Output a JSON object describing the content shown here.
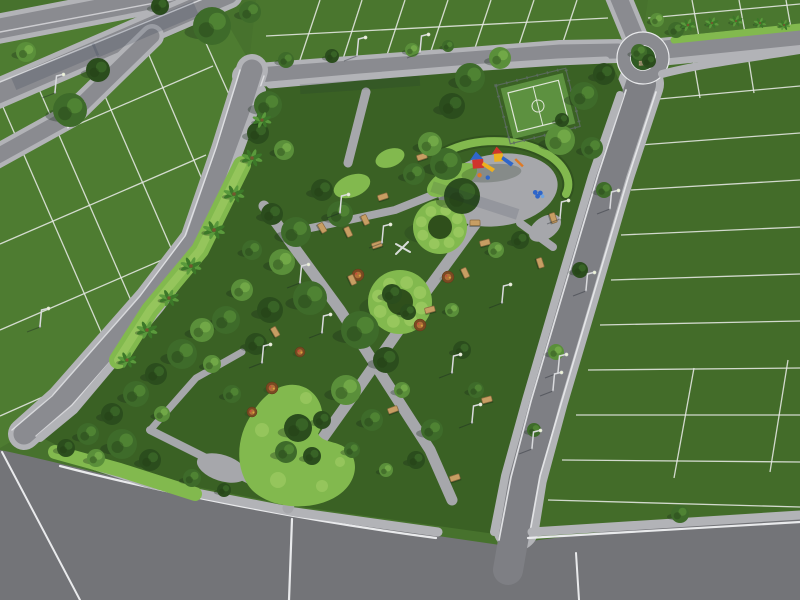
{
  "scene": {
    "title": "aerial-3d-render-residential-park-masterplan",
    "description": "Daylight aerial isometric 3D rendering of a residential land subdivision. A diagonal linear park with walking paths, a fenced mini sports court, a colorful playground plaza, circular clipped hedge rings, a kidney-shaped hedge bed, benches, street lamps and palm trees is surrounded by asphalt roads, a roundabout at top right, and green parcels divided by white lot lines.",
    "view": "aerial isometric",
    "time_of_day": "day"
  },
  "palette": {
    "base": "#47722d",
    "tl": "#4e7c31",
    "tc": "#4a762e",
    "tr": "#4a772f",
    "rb": "#436c29",
    "park_lawn": "#3a6124",
    "road": "#8a8b90",
    "road_main": "#7e7f84",
    "road_dark": "#737478",
    "sidewalk": "#b2b3b7",
    "path": "#a6a7ab",
    "white_line": "#e9eaec",
    "hedge": "#82b94e",
    "hedge_light": "#a5d068",
    "island": "#2f5a22",
    "court": "#5d9140",
    "court_line": "#dfe6d8",
    "fence": "#5c6b60",
    "play_red": "#d0342c",
    "play_blue": "#2f66c9",
    "play_yellow": "#edb01f",
    "play_orange": "#df7a25",
    "bench": "#c79e63",
    "bench_dark": "#8a6a3e",
    "bed_brown": "#7a4a22",
    "bed_orange": "#b06f38",
    "lamp": "#d9dadd",
    "shadow": "rgba(24,44,24,0.32)"
  },
  "features": {
    "lot_lines": [
      [
        0,
        158,
        213,
        66
      ],
      [
        0,
        244,
        206,
        155
      ],
      [
        0,
        330,
        185,
        250
      ],
      [
        0,
        416,
        90,
        376
      ],
      [
        35,
        80,
        136,
        312
      ],
      [
        88,
        57,
        178,
        264
      ],
      [
        140,
        34,
        210,
        198
      ],
      [
        192,
        12,
        236,
        110
      ],
      [
        0,
        100,
        108,
        348
      ],
      [
        298,
        66,
        320,
        0
      ],
      [
        342,
        62,
        362,
        0
      ],
      [
        386,
        58,
        405,
        0
      ],
      [
        430,
        54,
        448,
        0
      ],
      [
        474,
        51,
        491,
        0
      ],
      [
        518,
        48,
        534,
        0
      ],
      [
        562,
        45,
        577,
        0
      ],
      [
        266,
        36,
        608,
        18
      ],
      [
        700,
        42,
        692,
        0
      ],
      [
        746,
        38,
        739,
        0
      ],
      [
        792,
        34,
        786,
        0
      ],
      [
        648,
        18,
        800,
        4
      ],
      [
        648,
        100,
        800,
        86
      ],
      [
        640,
        145,
        800,
        133
      ],
      [
        631,
        190,
        800,
        180
      ],
      [
        621,
        235,
        800,
        227
      ],
      [
        611,
        280,
        800,
        274
      ],
      [
        600,
        325,
        800,
        321
      ],
      [
        588,
        370,
        800,
        368
      ],
      [
        576,
        415,
        800,
        415
      ],
      [
        562,
        460,
        800,
        462
      ],
      [
        548,
        500,
        800,
        507
      ],
      [
        694,
        368,
        674,
        478
      ],
      [
        788,
        360,
        770,
        472
      ],
      [
        700,
        98,
        692,
        52
      ],
      [
        754,
        93,
        747,
        49
      ]
    ],
    "trees": [
      [
        268,
        105,
        14,
        1
      ],
      [
        258,
        133,
        11,
        0
      ],
      [
        284,
        150,
        10,
        2
      ],
      [
        296,
        232,
        15,
        1
      ],
      [
        272,
        214,
        11,
        0
      ],
      [
        282,
        262,
        13,
        2
      ],
      [
        252,
        250,
        10,
        1
      ],
      [
        310,
        298,
        17,
        1
      ],
      [
        270,
        310,
        13,
        0
      ],
      [
        242,
        290,
        11,
        2
      ],
      [
        226,
        320,
        14,
        1
      ],
      [
        256,
        344,
        11,
        0
      ],
      [
        202,
        330,
        12,
        2
      ],
      [
        182,
        354,
        15,
        1
      ],
      [
        156,
        374,
        11,
        0
      ],
      [
        212,
        364,
        9,
        2
      ],
      [
        136,
        394,
        13,
        1
      ],
      [
        112,
        414,
        11,
        0
      ],
      [
        88,
        434,
        11,
        1
      ],
      [
        66,
        448,
        9,
        0
      ],
      [
        162,
        414,
        8,
        2
      ],
      [
        232,
        394,
        9,
        1
      ],
      [
        122,
        444,
        15,
        1
      ],
      [
        150,
        460,
        11,
        0
      ],
      [
        96,
        458,
        9,
        2
      ],
      [
        192,
        478,
        9,
        1
      ],
      [
        224,
        490,
        7,
        0
      ],
      [
        340,
        214,
        13,
        1
      ],
      [
        322,
        190,
        11,
        0
      ],
      [
        360,
        330,
        19,
        1
      ],
      [
        386,
        360,
        13,
        0
      ],
      [
        346,
        390,
        15,
        2
      ],
      [
        372,
        420,
        11,
        1
      ],
      [
        322,
        420,
        9,
        0
      ],
      [
        402,
        390,
        8,
        2
      ],
      [
        432,
        430,
        11,
        1
      ],
      [
        416,
        460,
        9,
        0
      ],
      [
        386,
        470,
        7,
        2
      ],
      [
        352,
        450,
        8,
        1
      ],
      [
        462,
        350,
        9,
        0
      ],
      [
        476,
        390,
        8,
        1
      ],
      [
        452,
        310,
        7,
        2
      ],
      [
        446,
        164,
        16,
        1
      ],
      [
        462,
        196,
        18,
        0
      ],
      [
        430,
        144,
        12,
        2
      ],
      [
        414,
        174,
        11,
        1
      ],
      [
        470,
        78,
        15,
        1
      ],
      [
        452,
        106,
        13,
        0
      ],
      [
        500,
        58,
        11,
        2
      ],
      [
        584,
        96,
        14,
        1
      ],
      [
        604,
        74,
        11,
        0
      ],
      [
        560,
        140,
        15,
        2
      ],
      [
        592,
        148,
        11,
        1
      ],
      [
        520,
        240,
        9,
        0
      ],
      [
        496,
        250,
        8,
        2
      ],
      [
        298,
        428,
        14,
        0
      ],
      [
        286,
        452,
        11,
        1
      ],
      [
        312,
        456,
        9,
        0
      ],
      [
        392,
        294,
        10,
        0
      ],
      [
        408,
        312,
        8,
        0
      ],
      [
        212,
        26,
        19,
        1
      ],
      [
        98,
        70,
        12,
        0
      ],
      [
        26,
        52,
        10,
        2
      ],
      [
        250,
        12,
        11,
        1
      ],
      [
        160,
        6,
        9,
        0
      ],
      [
        70,
        110,
        17,
        1
      ],
      [
        286,
        60,
        8,
        1
      ],
      [
        332,
        56,
        7,
        0
      ],
      [
        412,
        50,
        7,
        2
      ],
      [
        448,
        46,
        6,
        1
      ],
      [
        639,
        52,
        8,
        1
      ],
      [
        649,
        61,
        7,
        0
      ],
      [
        657,
        20,
        7,
        2
      ],
      [
        676,
        30,
        8,
        1
      ],
      [
        604,
        190,
        8,
        1
      ],
      [
        580,
        270,
        8,
        0
      ],
      [
        556,
        352,
        8,
        2
      ],
      [
        534,
        430,
        7,
        1
      ],
      [
        562,
        120,
        7,
        0
      ],
      [
        680,
        514,
        9,
        1
      ]
    ],
    "palms": [
      [
        252,
        158,
        1
      ],
      [
        234,
        194,
        1
      ],
      [
        214,
        230,
        1.05
      ],
      [
        191,
        266,
        1
      ],
      [
        169,
        298,
        0.95
      ],
      [
        147,
        330,
        1
      ],
      [
        127,
        360,
        0.9
      ],
      [
        262,
        120,
        0.9
      ],
      [
        688,
        25,
        0.7
      ],
      [
        712,
        23,
        0.65
      ],
      [
        736,
        21,
        0.65
      ],
      [
        760,
        23,
        0.6
      ],
      [
        784,
        25,
        0.6
      ]
    ],
    "benches": [
      [
        377,
        245,
        -18
      ],
      [
        485,
        243,
        -15
      ],
      [
        465,
        273,
        65
      ],
      [
        352,
        280,
        65
      ],
      [
        393,
        410,
        -20
      ],
      [
        487,
        400,
        -15
      ],
      [
        455,
        478,
        -18
      ],
      [
        275,
        332,
        60
      ],
      [
        430,
        310,
        -15
      ],
      [
        553,
        218,
        72
      ],
      [
        540,
        263,
        72
      ],
      [
        475,
        223,
        0
      ],
      [
        383,
        197,
        -18
      ],
      [
        365,
        220,
        65
      ],
      [
        422,
        157,
        -18
      ],
      [
        348,
        232,
        65
      ],
      [
        322,
        228,
        60
      ]
    ],
    "lamps": [
      [
        340,
        212
      ],
      [
        382,
        242
      ],
      [
        300,
        282
      ],
      [
        322,
        332
      ],
      [
        262,
        362
      ],
      [
        452,
        372
      ],
      [
        472,
        422
      ],
      [
        502,
        302
      ],
      [
        560,
        218
      ],
      [
        610,
        208
      ],
      [
        586,
        290
      ],
      [
        558,
        372
      ],
      [
        532,
        448
      ],
      [
        357,
        55
      ],
      [
        420,
        52
      ],
      [
        40,
        326
      ],
      [
        55,
        92
      ],
      [
        553,
        390
      ]
    ],
    "flower_beds": [
      [
        358,
        275,
        6
      ],
      [
        448,
        277,
        6
      ],
      [
        420,
        325,
        6
      ],
      [
        272,
        388,
        6
      ],
      [
        300,
        352,
        5
      ],
      [
        252,
        412,
        5
      ]
    ],
    "hedge_rings": [
      {
        "cx": 440,
        "cy": 227,
        "ro": 27,
        "ri": 12
      },
      {
        "cx": 400,
        "cy": 302,
        "ro": 32,
        "ri": 13
      }
    ],
    "counts": {
      "trees": 79,
      "palm_trees": 13,
      "benches": 17,
      "street_lamps": 18,
      "flower_beds": 6,
      "hedge_rings": 2,
      "playgrounds": 1,
      "sports_courts": 1,
      "roundabouts": 1
    }
  }
}
